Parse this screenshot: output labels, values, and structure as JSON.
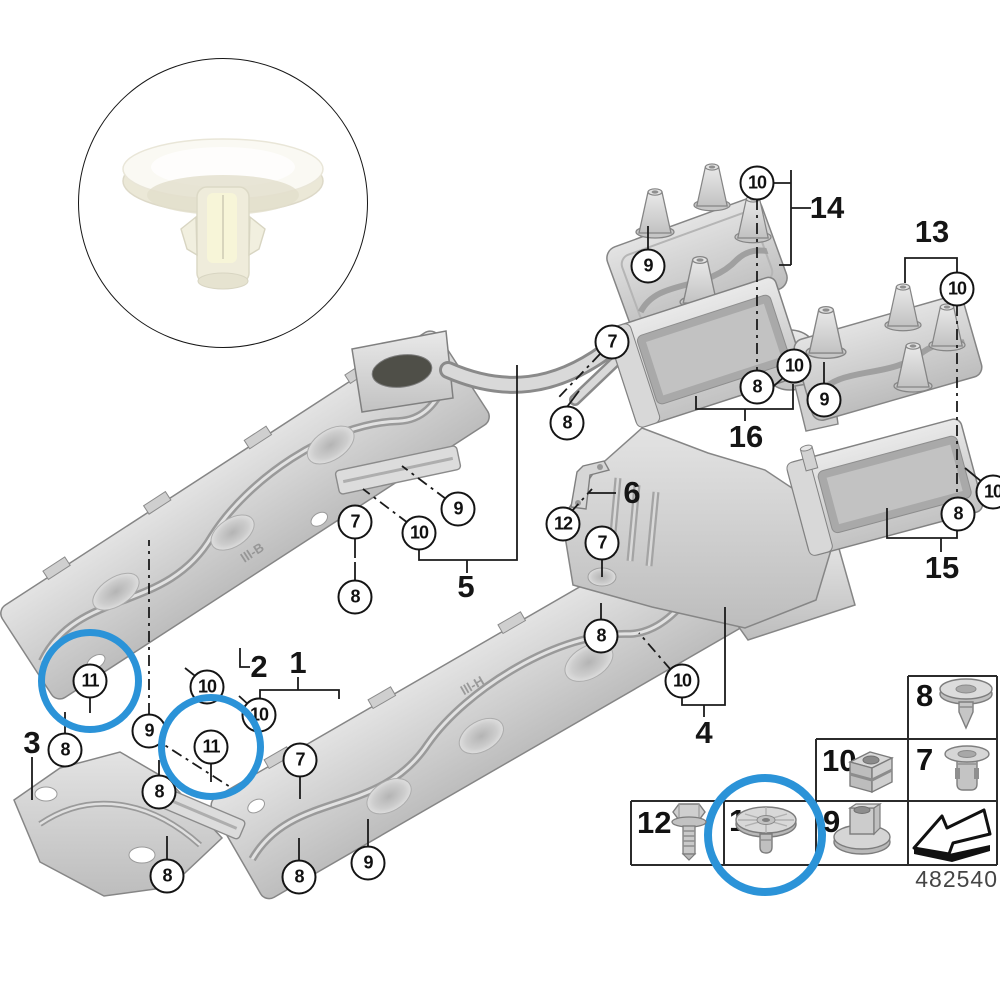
{
  "figure": {
    "background": "#ffffff",
    "highlight_color": "#2b93d8",
    "diagram_number": "482540"
  },
  "inset_photo": {
    "icon": "white-plastic-expanding-rivet-photo"
  },
  "callouts": [
    {
      "label": "10",
      "x": 757,
      "y": 183
    },
    {
      "label": "9",
      "x": 648,
      "y": 266
    },
    {
      "label": "10",
      "x": 957,
      "y": 289
    },
    {
      "label": "7",
      "x": 612,
      "y": 342
    },
    {
      "label": "10",
      "x": 794,
      "y": 366
    },
    {
      "label": "8",
      "x": 757,
      "y": 387
    },
    {
      "label": "9",
      "x": 824,
      "y": 400
    },
    {
      "label": "8",
      "x": 567,
      "y": 423
    },
    {
      "label": "10",
      "x": 993,
      "y": 492
    },
    {
      "label": "8",
      "x": 958,
      "y": 514
    },
    {
      "label": "9",
      "x": 458,
      "y": 509
    },
    {
      "label": "10",
      "x": 419,
      "y": 533
    },
    {
      "label": "12",
      "x": 563,
      "y": 524
    },
    {
      "label": "7",
      "x": 602,
      "y": 543
    },
    {
      "label": "7",
      "x": 355,
      "y": 522
    },
    {
      "label": "8",
      "x": 355,
      "y": 597
    },
    {
      "label": "8",
      "x": 601,
      "y": 636
    },
    {
      "label": "10",
      "x": 682,
      "y": 681
    },
    {
      "label": "10",
      "x": 207,
      "y": 687
    },
    {
      "label": "10",
      "x": 259,
      "y": 715
    },
    {
      "label": "9",
      "x": 149,
      "y": 731
    },
    {
      "label": "11",
      "x": 90,
      "y": 681,
      "ring": 45
    },
    {
      "label": "8",
      "x": 65,
      "y": 750
    },
    {
      "label": "11",
      "x": 211,
      "y": 747,
      "ring": 46
    },
    {
      "label": "8",
      "x": 159,
      "y": 792
    },
    {
      "label": "7",
      "x": 300,
      "y": 760
    },
    {
      "label": "8",
      "x": 167,
      "y": 876
    },
    {
      "label": "8",
      "x": 299,
      "y": 877
    },
    {
      "label": "9",
      "x": 368,
      "y": 863
    }
  ],
  "part_labels": [
    {
      "text": "14",
      "x": 827,
      "y": 208
    },
    {
      "text": "13",
      "x": 932,
      "y": 232
    },
    {
      "text": "16",
      "x": 746,
      "y": 437
    },
    {
      "text": "15",
      "x": 942,
      "y": 568
    },
    {
      "text": "5",
      "x": 466,
      "y": 587
    },
    {
      "text": "6",
      "x": 632,
      "y": 493
    },
    {
      "text": "4",
      "x": 704,
      "y": 733
    },
    {
      "text": "1",
      "x": 298,
      "y": 663
    },
    {
      "text": "2",
      "x": 259,
      "y": 667
    },
    {
      "text": "3",
      "x": 32,
      "y": 743
    }
  ],
  "panel_markings": [
    {
      "text": "lll-B",
      "x": 240,
      "y": 545,
      "angle": -33
    },
    {
      "text": "lll-H",
      "x": 460,
      "y": 678,
      "angle": -30
    }
  ],
  "legend": {
    "items": [
      {
        "num": "8",
        "icon": "expanding-rivet-icon"
      },
      {
        "num": "10",
        "icon": "cage-nut-icon"
      },
      {
        "num": "7",
        "icon": "expansion-rivet-icon"
      },
      {
        "num": "12",
        "icon": "hex-screw-icon"
      },
      {
        "num": "11",
        "icon": "push-rivet-icon",
        "highlighted": true
      },
      {
        "num": "9",
        "icon": "flange-nut-icon"
      },
      {
        "num": "",
        "icon": "continuation-arrow-icon"
      }
    ],
    "highlight_ring": {
      "x": 765,
      "y": 835,
      "r": 53
    }
  }
}
